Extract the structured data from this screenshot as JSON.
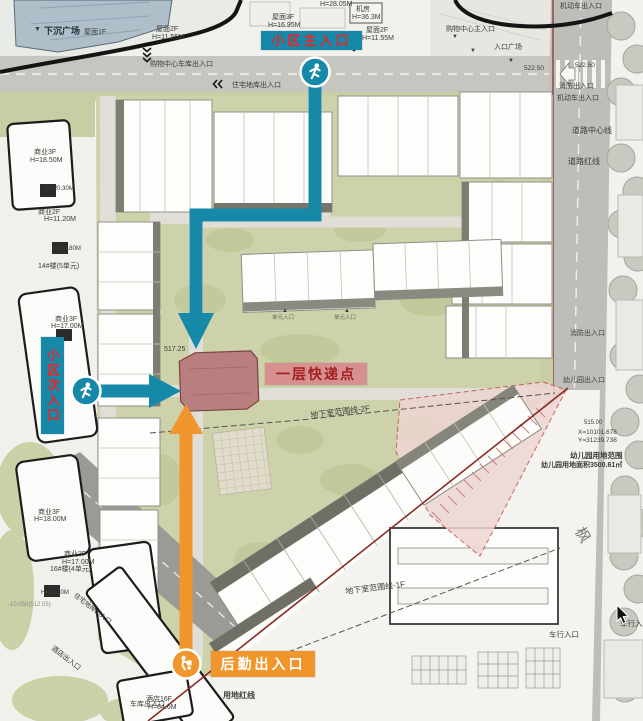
{
  "annotations": {
    "main_entrance": {
      "label": "小区主入口",
      "icon": "pedestrian-icon"
    },
    "secondary_entrance": {
      "label": "小区次入口",
      "icon": "pedestrian-icon"
    },
    "express_point": {
      "label": "一层快递点"
    },
    "logistics_entrance": {
      "label": "后勤出入口",
      "icon": "porter-icon"
    }
  },
  "colors": {
    "route_teal": "#1789a8",
    "route_orange": "#f0962c",
    "entrance_label_bg": "#1789a8",
    "entrance_label_text": "#e8262a",
    "express_label_bg": "#d69090",
    "express_label_text": "#a31f24",
    "logistics_label_bg": "#f0962c",
    "logistics_label_text": "#ffffff",
    "express_building": "#b97f7f",
    "site_green": "#ced2aa",
    "road_gray": "#bdbdb9",
    "boundary_black": "#141414",
    "land_red_line": "#8b2a25"
  },
  "map_labels": [
    {
      "t": "H=28.05M",
      "x": 320,
      "y": 1,
      "fs": 7
    },
    {
      "t": "屋面3F",
      "x": 272,
      "y": 14,
      "fs": 7
    },
    {
      "t": "H=16.95M",
      "x": 268,
      "y": 22,
      "fs": 7
    },
    {
      "t": "机房",
      "x": 356,
      "y": 6,
      "fs": 7
    },
    {
      "t": "H=36.3M",
      "x": 352,
      "y": 14,
      "fs": 7
    },
    {
      "t": "屋面2F",
      "x": 156,
      "y": 26,
      "fs": 7
    },
    {
      "t": "H=11.55M",
      "x": 152,
      "y": 34,
      "fs": 7
    },
    {
      "t": "屋面1F",
      "x": 84,
      "y": 29,
      "fs": 7
    },
    {
      "t": "屋面2F",
      "x": 366,
      "y": 27,
      "fs": 7
    },
    {
      "t": "H=11.55M",
      "x": 362,
      "y": 35,
      "fs": 7
    },
    {
      "t": "▼",
      "x": 34,
      "y": 26,
      "fs": 7
    },
    {
      "t": "下沉广场",
      "x": 44,
      "y": 27,
      "fs": 9,
      "b": true,
      "c": "#23313a"
    },
    {
      "t": "购物中心车库出入口",
      "x": 150,
      "y": 61,
      "fs": 7
    },
    {
      "t": "购物中心主入口",
      "x": 446,
      "y": 26,
      "fs": 7
    },
    {
      "t": "▼",
      "x": 452,
      "y": 34,
      "fs": 6
    },
    {
      "t": "▼",
      "x": 470,
      "y": 48,
      "fs": 6
    },
    {
      "t": "入口广场",
      "x": 494,
      "y": 44,
      "fs": 7
    },
    {
      "t": "▼",
      "x": 508,
      "y": 58,
      "fs": 6
    },
    {
      "t": "住宅地库出入口",
      "x": 232,
      "y": 82,
      "fs": 7
    },
    {
      "t": "522.50",
      "x": 524,
      "y": 66,
      "fs": 6.5
    },
    {
      "t": "机动车出入口",
      "x": 560,
      "y": 3,
      "fs": 7
    },
    {
      "t": "522.50",
      "x": 575,
      "y": 63,
      "fs": 6.5
    },
    {
      "t": "消防出入口",
      "x": 559,
      "y": 83,
      "fs": 7
    },
    {
      "t": "机动车出入口",
      "x": 557,
      "y": 95,
      "fs": 7
    },
    {
      "t": "道路中心线",
      "x": 572,
      "y": 127,
      "fs": 8
    },
    {
      "t": "道路红线",
      "x": 568,
      "y": 158,
      "fs": 8
    },
    {
      "t": "消防出入口",
      "x": 570,
      "y": 330,
      "fs": 7
    },
    {
      "t": "幼儿园出入口",
      "x": 563,
      "y": 377,
      "fs": 7
    },
    {
      "t": "515.00",
      "x": 584,
      "y": 420,
      "fs": 6
    },
    {
      "t": "X=10101.678",
      "x": 578,
      "y": 430,
      "fs": 6.5
    },
    {
      "t": "Y=31239.738",
      "x": 578,
      "y": 438,
      "fs": 6.5
    },
    {
      "t": "幼儿园用地范围",
      "x": 570,
      "y": 452,
      "fs": 7.5,
      "b": true
    },
    {
      "t": "幼儿园用地面积3500.61㎡",
      "x": 541,
      "y": 462,
      "fs": 7,
      "b": true
    },
    {
      "t": "车行入口",
      "x": 549,
      "y": 631,
      "fs": 7.5
    },
    {
      "t": "车行入口",
      "x": 620,
      "y": 620,
      "fs": 7.5
    },
    {
      "t": "枫",
      "x": 585,
      "y": 525,
      "fs": 15,
      "c": "#787872",
      "r": 60
    },
    {
      "t": "商业3F",
      "x": 34,
      "y": 149,
      "fs": 7
    },
    {
      "t": "H=18.50M",
      "x": 30,
      "y": 157,
      "fs": 7
    },
    {
      "t": "H=20.30M",
      "x": 46,
      "y": 186,
      "fs": 6
    },
    {
      "t": "商业2F",
      "x": 38,
      "y": 209,
      "fs": 7
    },
    {
      "t": "H=11.20M",
      "x": 44,
      "y": 216,
      "fs": 7
    },
    {
      "t": "H=18.80M",
      "x": 53,
      "y": 246,
      "fs": 6
    },
    {
      "t": "14#楼(5单元)",
      "x": 38,
      "y": 263,
      "fs": 7
    },
    {
      "t": "商业3F",
      "x": 55,
      "y": 316,
      "fs": 7
    },
    {
      "t": "H=17.00M",
      "x": 51,
      "y": 323,
      "fs": 7
    },
    {
      "t": "商业3F",
      "x": 38,
      "y": 509,
      "fs": 7
    },
    {
      "t": "H=18.00M",
      "x": 34,
      "y": 516,
      "fs": 7
    },
    {
      "t": "商业3F",
      "x": 64,
      "y": 551,
      "fs": 7
    },
    {
      "t": "H=17.00M",
      "x": 62,
      "y": 559,
      "fs": 7
    },
    {
      "t": "16#楼(4单元)",
      "x": 50,
      "y": 566,
      "fs": 7
    },
    {
      "t": "H=18.60M",
      "x": 41,
      "y": 590,
      "fs": 6
    },
    {
      "t": "-10.050(512.05)",
      "x": 8,
      "y": 602,
      "fs": 6,
      "c": "#8a8a8a"
    },
    {
      "t": "住宅地库出入口",
      "x": 76,
      "y": 593,
      "fs": 6.5,
      "r": 38
    },
    {
      "t": "酒店出入口",
      "x": 54,
      "y": 645,
      "fs": 7,
      "r": 38
    },
    {
      "t": "酒店16F",
      "x": 146,
      "y": 696,
      "fs": 7
    },
    {
      "t": "H=64.6M",
      "x": 148,
      "y": 704,
      "fs": 7
    },
    {
      "t": "地下室范围线-2F",
      "x": 310,
      "y": 412,
      "fs": 8,
      "r": -7
    },
    {
      "t": "地下室范围线-1F",
      "x": 345,
      "y": 588,
      "fs": 8,
      "r": -7
    },
    {
      "t": "用地红线",
      "x": 223,
      "y": 692,
      "fs": 8,
      "b": true
    },
    {
      "t": "车库出入口",
      "x": 130,
      "y": 701,
      "fs": 7
    },
    {
      "t": "517.25",
      "x": 164,
      "y": 346,
      "fs": 7
    },
    {
      "t": "▲",
      "x": 282,
      "y": 308,
      "fs": 6
    },
    {
      "t": "单元入口",
      "x": 272,
      "y": 316,
      "fs": 5.5,
      "c": "#666660"
    },
    {
      "t": "▲",
      "x": 344,
      "y": 308,
      "fs": 6
    },
    {
      "t": "单元入口",
      "x": 334,
      "y": 316,
      "fs": 5.5,
      "c": "#666660"
    }
  ]
}
